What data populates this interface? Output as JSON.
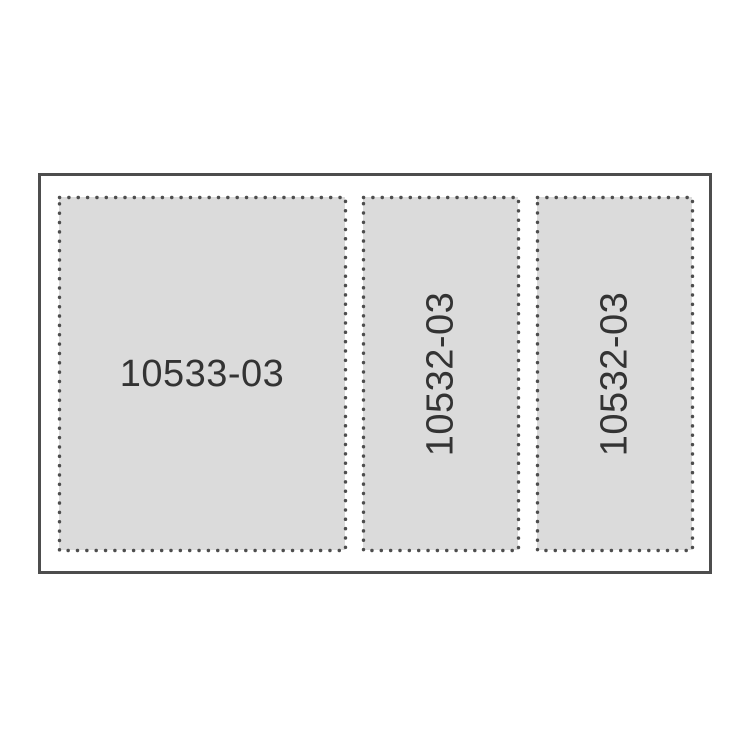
{
  "panels": [
    {
      "label": "10533-03",
      "orientation": "horizontal"
    },
    {
      "label": "10532-03",
      "orientation": "vertical"
    },
    {
      "label": "10532-03",
      "orientation": "vertical"
    }
  ],
  "colors": {
    "page_bg": "#ffffff",
    "frame_border": "#4d4d4d",
    "panel_fill": "#dbdbdb",
    "dot_color": "#4d4d4d",
    "label_text": "#333333"
  }
}
